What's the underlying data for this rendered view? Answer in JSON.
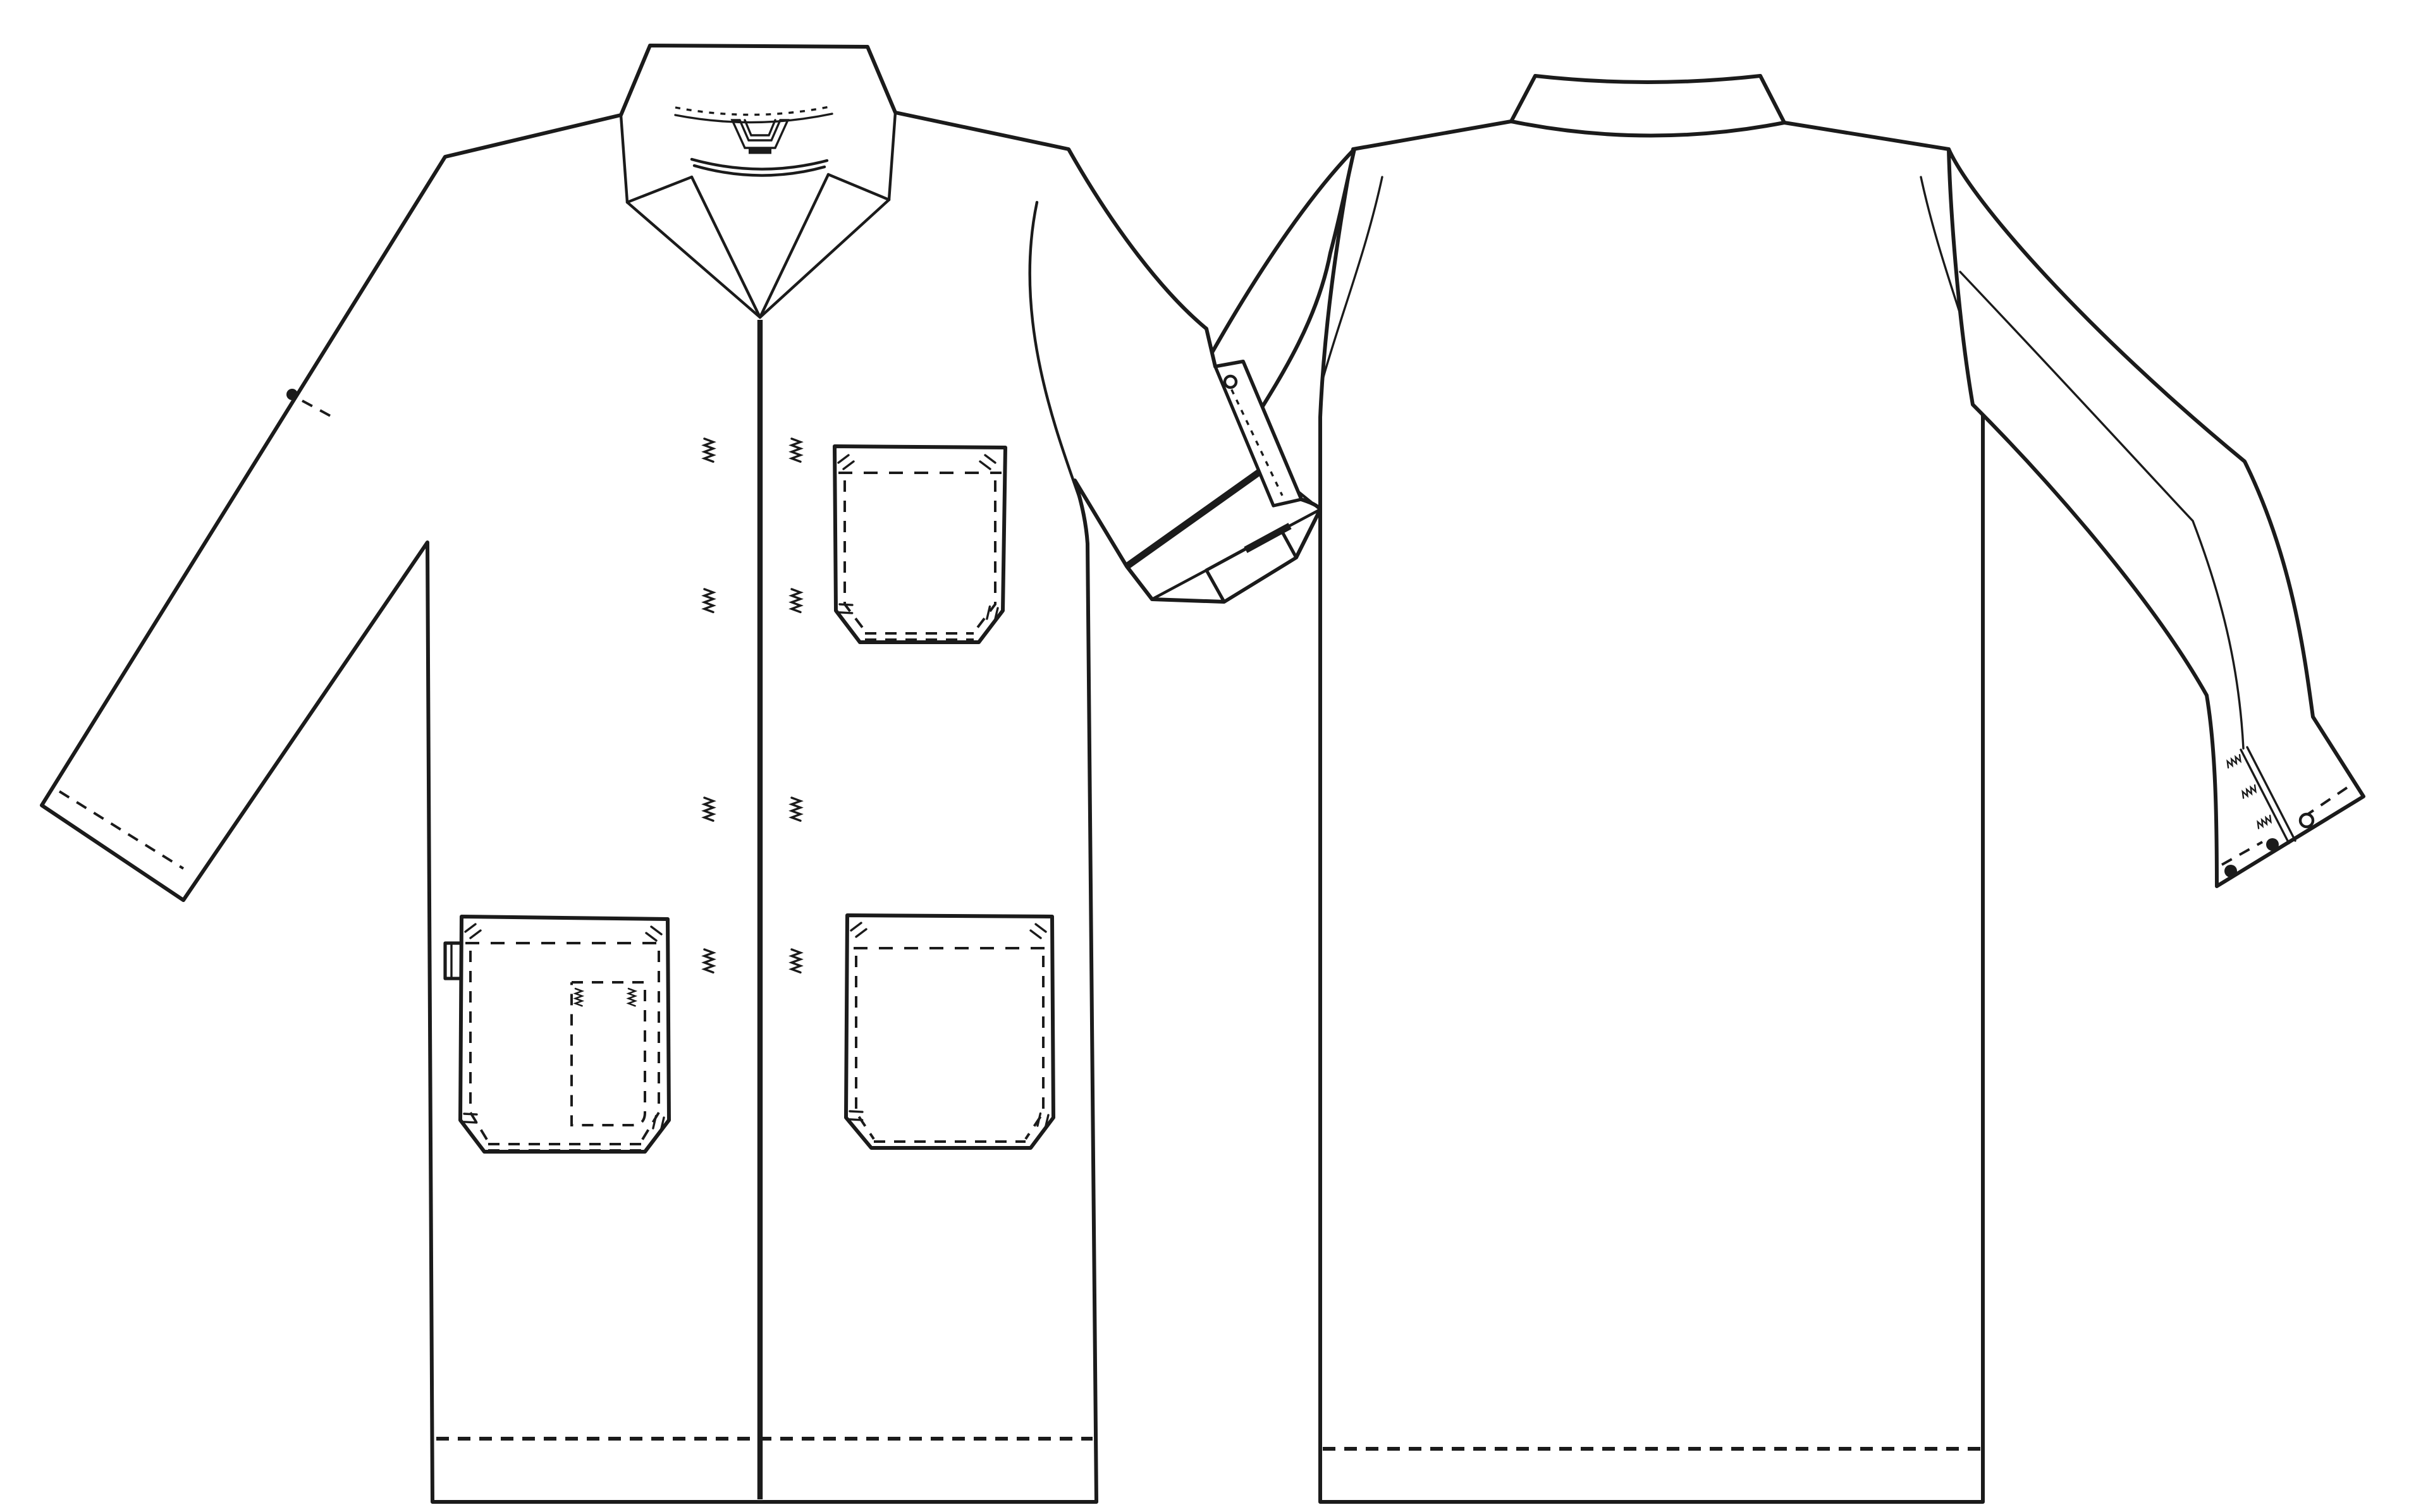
{
  "meta": {
    "title": "Lab coat technical flat sketch - front and back views",
    "drawing_type": "garment-technical-flat",
    "garment": "button-front lab coat"
  },
  "colors": {
    "background": "#ffffff",
    "line": "#1b1b1b"
  },
  "views": [
    {
      "id": "front",
      "label": "Front view",
      "features": [
        "notched-lapel-collar",
        "hanger-loop",
        "neck-seam-stitching",
        "center-front-placket",
        "buttonhole-zigzag-pairs",
        "chest-patch-pocket",
        "left-hip-patch-pocket-with-pen-compartment-and-side-tab",
        "right-hip-patch-pocket",
        "left-sleeve-with-elbow-roll-button",
        "right-sleeve-rolled-up-with-button-tab",
        "dashed-hem-stitch",
        "dashed-cuff-stitch"
      ],
      "buttonhole_pairs": 4,
      "pockets": 3
    },
    {
      "id": "back",
      "label": "Back view",
      "features": [
        "collar-band",
        "armhole-seams",
        "two-piece-sleeve-seam",
        "right-cuff-vent-with-zigzag-stitch",
        "cuff-buttons",
        "dashed-hem-stitch",
        "left-sleeve-hidden-behind-front-view"
      ],
      "cuff_buttons_solid": 2,
      "cuff_buttons_open": 1
    }
  ]
}
